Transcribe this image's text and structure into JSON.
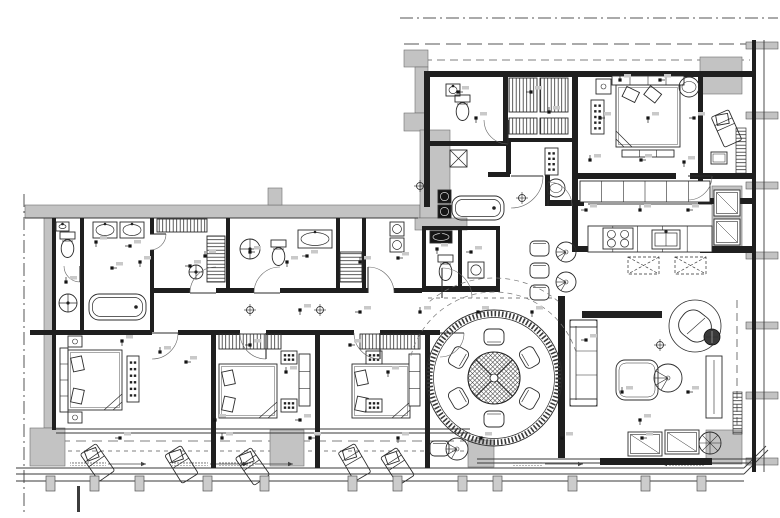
{
  "meta": {
    "kind": "architectural-floor-plan",
    "canvas": {
      "width": 780,
      "height": 518
    }
  },
  "palette": {
    "line": "#2b2b2b",
    "wall": "#1f1f1f",
    "gray": "#c3c3c3",
    "gray_dark": "#9d9d9d",
    "thin": "#3a3a3a",
    "dash": "#555555",
    "white": "#ffffff",
    "dark_fill": "#151515"
  },
  "boundaries": {
    "dashes": [
      [
        400,
        18,
        778,
        18,
        "13 4 2 4",
        1.0
      ],
      [
        404,
        44,
        772,
        44,
        "15 6",
        1.0
      ],
      [
        424,
        60,
        750,
        60,
        "8 5",
        0.8
      ],
      [
        24,
        194,
        24,
        512,
        "13 4 2 4",
        1.0
      ],
      [
        60,
        441,
        466,
        441,
        "10 6",
        0.8
      ],
      [
        60,
        451,
        466,
        451,
        "4 4",
        0.7
      ],
      [
        737,
        300,
        737,
        456,
        "8 5",
        0.8
      ],
      [
        428,
        298,
        556,
        298,
        "4 4",
        0.7
      ]
    ]
  },
  "walls": {
    "black": [
      [
        428,
        71,
        328,
        6
      ],
      [
        424,
        71,
        6,
        136
      ],
      [
        503,
        77,
        5,
        66
      ],
      [
        572,
        71,
        6,
        108
      ],
      [
        698,
        77,
        5,
        125
      ],
      [
        428,
        141,
        80,
        5
      ],
      [
        508,
        138,
        64,
        4
      ],
      [
        572,
        173,
        104,
        6
      ],
      [
        690,
        173,
        66,
        6
      ],
      [
        572,
        179,
        6,
        72
      ],
      [
        572,
        246,
        18,
        6
      ],
      [
        700,
        246,
        56,
        7
      ],
      [
        698,
        198,
        58,
        6
      ],
      [
        52,
        218,
        4,
        212
      ],
      [
        80,
        218,
        4,
        112
      ],
      [
        150,
        218,
        4,
        16
      ],
      [
        150,
        250,
        4,
        82
      ],
      [
        226,
        218,
        4,
        72
      ],
      [
        336,
        218,
        4,
        74
      ],
      [
        362,
        218,
        4,
        74
      ],
      [
        150,
        288,
        40,
        5
      ],
      [
        216,
        288,
        38,
        5
      ],
      [
        280,
        288,
        88,
        5
      ],
      [
        394,
        288,
        28,
        5
      ],
      [
        30,
        330,
        122,
        5
      ],
      [
        178,
        330,
        62,
        5
      ],
      [
        266,
        330,
        88,
        5
      ],
      [
        380,
        330,
        60,
        5
      ],
      [
        211,
        335,
        5,
        133
      ],
      [
        315,
        335,
        5,
        133
      ],
      [
        425,
        335,
        5,
        133
      ],
      [
        558,
        296,
        7,
        162
      ],
      [
        506,
        140,
        5,
        34
      ],
      [
        488,
        172,
        22,
        5
      ],
      [
        545,
        172,
        5,
        34
      ],
      [
        548,
        200,
        36,
        6
      ],
      [
        422,
        226,
        78,
        4
      ],
      [
        422,
        226,
        4,
        66
      ],
      [
        458,
        230,
        4,
        58
      ],
      [
        496,
        226,
        4,
        66
      ],
      [
        422,
        286,
        78,
        6
      ],
      [
        600,
        458,
        112,
        7
      ],
      [
        752,
        40,
        4,
        432
      ]
    ],
    "thin": [
      [
        764,
        40,
        764,
        472
      ],
      [
        56,
        429,
        470,
        429
      ],
      [
        56,
        433,
        470,
        433
      ],
      [
        477,
        459,
        600,
        459
      ],
      [
        477,
        463,
        600,
        463
      ],
      [
        712,
        459,
        752,
        459
      ],
      [
        712,
        463,
        752,
        463
      ],
      [
        16,
        468,
        744,
        468
      ],
      [
        16,
        474,
        744,
        474
      ],
      [
        16,
        481,
        744,
        481
      ],
      [
        744,
        468,
        766,
        446
      ],
      [
        744,
        474,
        768,
        450
      ],
      [
        588,
        204,
        712,
        204
      ],
      [
        25,
        218,
        418,
        218
      ]
    ]
  },
  "masses": {
    "gray": [
      [
        404,
        50,
        24,
        17
      ],
      [
        415,
        67,
        13,
        46
      ],
      [
        404,
        113,
        24,
        18
      ],
      [
        700,
        57,
        42,
        37
      ],
      [
        25,
        205,
        395,
        13
      ],
      [
        268,
        188,
        14,
        17
      ],
      [
        44,
        218,
        10,
        210
      ],
      [
        30,
        428,
        35,
        38
      ],
      [
        270,
        430,
        34,
        36
      ],
      [
        468,
        440,
        26,
        27
      ],
      [
        706,
        430,
        36,
        34
      ],
      [
        712,
        186,
        30,
        62
      ],
      [
        420,
        130,
        30,
        88
      ],
      [
        415,
        218,
        52,
        12
      ]
    ],
    "mullion_y": [
      42,
      112,
      182,
      252,
      322,
      392,
      458
    ],
    "tick": [
      77,
      486,
      3,
      26
    ]
  },
  "railing": {
    "posts_x": [
      46,
      90,
      135,
      203,
      260,
      348,
      393,
      458,
      493,
      568,
      641,
      697
    ]
  },
  "furniture": [
    {
      "t": "panel",
      "x": 612,
      "y": 76,
      "w": 72,
      "h": 9,
      "n": 4
    },
    {
      "t": "bed",
      "x": 616,
      "y": 85,
      "w": 64,
      "h": 62,
      "dir": "top"
    },
    {
      "t": "nightstand",
      "x": 596,
      "y": 79,
      "w": 15,
      "h": 15
    },
    {
      "t": "sidetable",
      "cx": 689,
      "cy": 87,
      "r": 10
    },
    {
      "t": "dresser",
      "x": 591,
      "y": 100,
      "w": 13,
      "h": 34,
      "rows": 5,
      "cols": 2
    },
    {
      "t": "panel",
      "x": 622,
      "y": 150,
      "w": 52,
      "h": 7,
      "n": 3
    },
    {
      "t": "lounge",
      "x": 717,
      "y": 112,
      "rot": -24
    },
    {
      "t": "tables",
      "x": 711,
      "y": 152,
      "w": 16,
      "h": 12
    },
    {
      "t": "hang",
      "x": 509,
      "y": 78,
      "w": 28,
      "h": 34,
      "o": "v"
    },
    {
      "t": "hang",
      "x": 540,
      "y": 78,
      "w": 28,
      "h": 34,
      "o": "v"
    },
    {
      "t": "hang",
      "x": 509,
      "y": 118,
      "w": 28,
      "h": 16,
      "o": "v"
    },
    {
      "t": "hang",
      "x": 540,
      "y": 118,
      "w": 28,
      "h": 16,
      "o": "v"
    },
    {
      "t": "sink",
      "x": 446,
      "y": 84,
      "w": 14,
      "h": 12
    },
    {
      "t": "toilet",
      "x": 455,
      "y": 95
    },
    {
      "t": "showerx",
      "x": 450,
      "y": 150,
      "s": 17
    },
    {
      "t": "tub",
      "x": 452,
      "y": 196,
      "w": 52,
      "h": 24
    },
    {
      "t": "washer",
      "x": 438,
      "y": 190,
      "s": 13,
      "dark": 1
    },
    {
      "t": "washer",
      "x": 438,
      "y": 205,
      "s": 13,
      "dark": 1
    },
    {
      "t": "counter",
      "x": 580,
      "y": 181,
      "w": 130,
      "h": 21,
      "seg": 6
    },
    {
      "t": "counter",
      "x": 588,
      "y": 226,
      "w": 124,
      "h": 26,
      "seg": 5
    },
    {
      "t": "hob",
      "x": 603,
      "y": 228,
      "w": 30,
      "h": 21
    },
    {
      "t": "ksink",
      "x": 652,
      "y": 230,
      "w": 28,
      "h": 19
    },
    {
      "t": "islandx",
      "x": 628,
      "y": 257,
      "w": 31,
      "h": 17
    },
    {
      "t": "islandx",
      "x": 675,
      "y": 257,
      "w": 31,
      "h": 17
    },
    {
      "t": "cabinet",
      "x": 714,
      "y": 190,
      "w": 26,
      "h": 26
    },
    {
      "t": "cabinet",
      "x": 714,
      "y": 219,
      "w": 26,
      "h": 26
    },
    {
      "t": "dining",
      "cx": 494,
      "cy": 378
    },
    {
      "t": "dresser",
      "x": 545,
      "y": 148,
      "w": 13,
      "h": 27,
      "rows": 4,
      "cols": 2
    },
    {
      "t": "sidetable",
      "cx": 556,
      "cy": 188,
      "r": 9
    },
    {
      "t": "chairr",
      "x": 530,
      "y": 241,
      "w": 19,
      "h": 15
    },
    {
      "t": "chairr",
      "x": 530,
      "y": 263,
      "w": 19,
      "h": 15
    },
    {
      "t": "chairr",
      "x": 530,
      "y": 285,
      "w": 19,
      "h": 15
    },
    {
      "t": "chairfan",
      "cx": 566,
      "cy": 252,
      "r": 10
    },
    {
      "t": "chairfan",
      "cx": 566,
      "cy": 282,
      "r": 10
    },
    {
      "t": "tv",
      "x": 582,
      "y": 311,
      "w": 80,
      "h": 7
    },
    {
      "t": "sofa",
      "x": 570,
      "y": 320,
      "w": 27,
      "h": 86
    },
    {
      "t": "ctable",
      "x": 616,
      "y": 360,
      "w": 42,
      "h": 40
    },
    {
      "t": "chairfan",
      "cx": 668,
      "cy": 378,
      "r": 14
    },
    {
      "t": "armchair",
      "cx": 695,
      "cy": 326,
      "r": 26
    },
    {
      "t": "sidetabledark",
      "cx": 712,
      "cy": 337,
      "r": 8
    },
    {
      "t": "console",
      "x": 706,
      "y": 356,
      "w": 16,
      "h": 62
    },
    {
      "t": "cabinet",
      "x": 628,
      "y": 432,
      "w": 34,
      "h": 24
    },
    {
      "t": "cabinet",
      "x": 665,
      "y": 430,
      "w": 34,
      "h": 24
    },
    {
      "t": "rtablex",
      "cx": 710,
      "cy": 443,
      "r": 11
    },
    {
      "t": "chairr",
      "x": 430,
      "y": 441,
      "w": 19,
      "h": 15
    },
    {
      "t": "chairfan",
      "cx": 457,
      "cy": 449,
      "r": 11
    },
    {
      "t": "panel",
      "x": 60,
      "y": 348,
      "w": 8,
      "h": 64,
      "n": 4,
      "o": "v"
    },
    {
      "t": "bed",
      "x": 68,
      "y": 350,
      "w": 54,
      "h": 60,
      "dir": "left"
    },
    {
      "t": "dresser",
      "x": 127,
      "y": 356,
      "w": 12,
      "h": 46,
      "rows": 6,
      "cols": 2
    },
    {
      "t": "nightstand",
      "x": 68,
      "y": 336,
      "w": 14,
      "h": 11
    },
    {
      "t": "nightstand",
      "x": 68,
      "y": 412,
      "w": 14,
      "h": 11
    },
    {
      "t": "hang",
      "x": 219,
      "y": 334,
      "w": 62,
      "h": 15,
      "o": "v"
    },
    {
      "t": "bed",
      "x": 219,
      "y": 364,
      "w": 58,
      "h": 54,
      "dir": "left"
    },
    {
      "t": "dresser",
      "x": 281,
      "y": 351,
      "w": 16,
      "h": 13,
      "rows": 2,
      "cols": 3
    },
    {
      "t": "dresser",
      "x": 281,
      "y": 399,
      "w": 16,
      "h": 13,
      "rows": 2,
      "cols": 3
    },
    {
      "t": "panel",
      "x": 299,
      "y": 354,
      "w": 11,
      "h": 52,
      "n": 3,
      "o": "v"
    },
    {
      "t": "hang",
      "x": 360,
      "y": 334,
      "w": 60,
      "h": 15,
      "o": "v"
    },
    {
      "t": "bed",
      "x": 352,
      "y": 364,
      "w": 58,
      "h": 54,
      "dir": "left"
    },
    {
      "t": "dresser",
      "x": 366,
      "y": 351,
      "w": 16,
      "h": 13,
      "rows": 2,
      "cols": 3
    },
    {
      "t": "dresser",
      "x": 366,
      "y": 399,
      "w": 16,
      "h": 13,
      "rows": 2,
      "cols": 3
    },
    {
      "t": "panel",
      "x": 409,
      "y": 354,
      "w": 11,
      "h": 52,
      "n": 3,
      "o": "v"
    },
    {
      "t": "lounge",
      "x": 88,
      "y": 446,
      "rot": -35
    },
    {
      "t": "lounge",
      "x": 172,
      "y": 448,
      "rot": -32
    },
    {
      "t": "lounge",
      "x": 243,
      "y": 450,
      "rot": -35
    },
    {
      "t": "lounge",
      "x": 345,
      "y": 446,
      "rot": -30
    },
    {
      "t": "lounge",
      "x": 388,
      "y": 450,
      "rot": -33
    },
    {
      "t": "sink",
      "x": 56,
      "y": 222,
      "w": 13,
      "h": 9
    },
    {
      "t": "toilet",
      "x": 60,
      "y": 232
    },
    {
      "t": "showerc",
      "cx": 68,
      "cy": 303,
      "r": 9
    },
    {
      "t": "sink",
      "x": 93,
      "y": 222,
      "w": 24,
      "h": 16
    },
    {
      "t": "sink",
      "x": 120,
      "y": 222,
      "w": 24,
      "h": 16
    },
    {
      "t": "tub",
      "x": 89,
      "y": 294,
      "w": 57,
      "h": 26
    },
    {
      "t": "hang",
      "x": 157,
      "y": 219,
      "w": 50,
      "h": 13,
      "o": "v"
    },
    {
      "t": "hang",
      "x": 207,
      "y": 236,
      "w": 18,
      "h": 46,
      "o": "h"
    },
    {
      "t": "showerc",
      "cx": 196,
      "cy": 272,
      "r": 7
    },
    {
      "t": "showerc",
      "cx": 250,
      "cy": 249,
      "r": 10
    },
    {
      "t": "toilet",
      "x": 271,
      "y": 240
    },
    {
      "t": "sink",
      "x": 298,
      "y": 230,
      "w": 34,
      "h": 18
    },
    {
      "t": "hang",
      "x": 340,
      "y": 252,
      "w": 22,
      "h": 30,
      "o": "h"
    },
    {
      "t": "washer",
      "x": 390,
      "y": 222,
      "s": 14
    },
    {
      "t": "washer",
      "x": 390,
      "y": 238,
      "s": 14
    },
    {
      "t": "sink",
      "x": 430,
      "y": 231,
      "w": 22,
      "h": 12,
      "dark": 1
    },
    {
      "t": "toilet",
      "x": 438,
      "y": 255
    },
    {
      "t": "washer",
      "x": 468,
      "y": 262,
      "s": 16
    }
  ],
  "doors": [
    [
      152,
      333,
      26,
      0,
      90
    ],
    [
      266,
      333,
      26,
      90,
      180
    ],
    [
      380,
      333,
      26,
      90,
      180
    ],
    [
      440,
      333,
      24,
      0,
      90
    ],
    [
      216,
      293,
      26,
      180,
      270
    ],
    [
      280,
      293,
      26,
      180,
      270
    ],
    [
      368,
      293,
      26,
      270,
      360
    ],
    [
      511,
      176,
      32,
      0,
      90
    ],
    [
      548,
      206,
      24,
      270,
      360
    ],
    [
      442,
      298,
      30,
      270,
      360
    ],
    [
      508,
      120,
      24,
      90,
      180
    ],
    [
      688,
      176,
      24,
      0,
      90
    ],
    [
      150,
      234,
      16,
      0,
      90
    ],
    [
      80,
      266,
      16,
      90,
      180
    ]
  ],
  "dashed_arcs": [
    [
      494,
      378,
      86,
      195,
      345
    ],
    [
      494,
      378,
      100,
      230,
      310
    ]
  ],
  "planters": [
    [
      736,
      128,
      10,
      46
    ],
    [
      733,
      392,
      9,
      42
    ]
  ],
  "speckles": [
    [
      70,
      461,
      36,
      5
    ],
    [
      172,
      461,
      36,
      5
    ],
    [
      218,
      461,
      36,
      5
    ],
    [
      512,
      461,
      30,
      5
    ],
    [
      668,
      461,
      36,
      5
    ]
  ],
  "arrows": [
    [
      108,
      464,
      146,
      464
    ],
    [
      210,
      464,
      248,
      464
    ],
    [
      255,
      464,
      293,
      464
    ],
    [
      545,
      464,
      583,
      464
    ],
    [
      700,
      464,
      662,
      464
    ]
  ],
  "symbols": {
    "outlets": [
      [
        66,
        282
      ],
      [
        112,
        268
      ],
      [
        140,
        262
      ],
      [
        190,
        266
      ],
      [
        205,
        256
      ],
      [
        250,
        252
      ],
      [
        287,
        262
      ],
      [
        307,
        256
      ],
      [
        360,
        262
      ],
      [
        398,
        258
      ],
      [
        437,
        249
      ],
      [
        471,
        252
      ],
      [
        160,
        352
      ],
      [
        186,
        362
      ],
      [
        122,
        341
      ],
      [
        250,
        345
      ],
      [
        286,
        372
      ],
      [
        350,
        345
      ],
      [
        388,
        372
      ],
      [
        300,
        420
      ],
      [
        215,
        420
      ],
      [
        458,
        92
      ],
      [
        476,
        118
      ],
      [
        531,
        92
      ],
      [
        549,
        112
      ],
      [
        600,
        118
      ],
      [
        648,
        118
      ],
      [
        694,
        118
      ],
      [
        590,
        160
      ],
      [
        641,
        160
      ],
      [
        684,
        162
      ],
      [
        586,
        210
      ],
      [
        640,
        210
      ],
      [
        688,
        210
      ],
      [
        300,
        310
      ],
      [
        360,
        312
      ],
      [
        420,
        312
      ],
      [
        478,
        312
      ],
      [
        532,
        312
      ],
      [
        586,
        340
      ],
      [
        622,
        392
      ],
      [
        688,
        392
      ],
      [
        640,
        420
      ],
      [
        120,
        438
      ],
      [
        222,
        438
      ],
      [
        310,
        438
      ],
      [
        398,
        438
      ],
      [
        481,
        438
      ],
      [
        562,
        438
      ],
      [
        642,
        438
      ],
      [
        96,
        242
      ],
      [
        130,
        246
      ],
      [
        620,
        80
      ],
      [
        660,
        80
      ]
    ],
    "lights": [
      [
        420,
        186
      ],
      [
        522,
        198
      ],
      [
        320,
        310
      ],
      [
        660,
        345
      ],
      [
        250,
        310
      ]
    ]
  }
}
